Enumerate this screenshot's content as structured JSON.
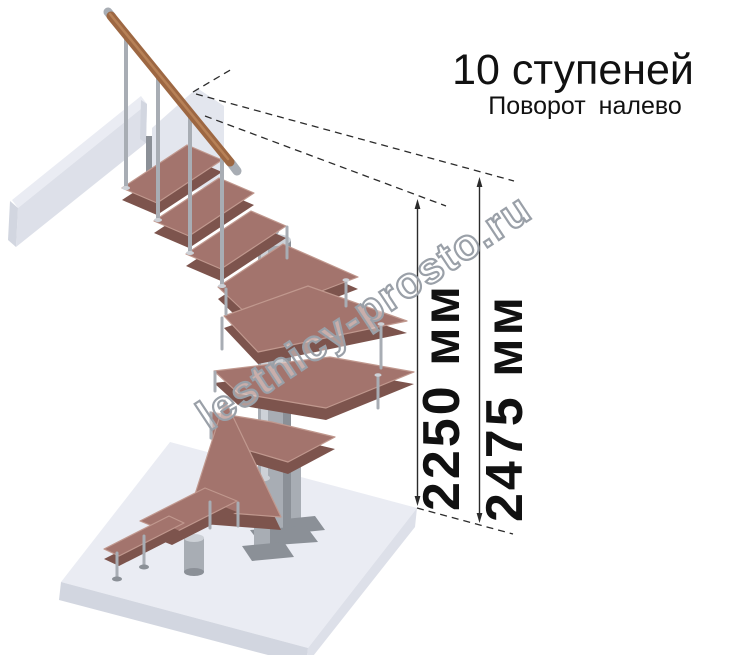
{
  "title": "10 ступеней",
  "subtitle": "Поворот налево",
  "dimensions": [
    {
      "label": "2250 мм"
    },
    {
      "label": "2475 мм"
    }
  ],
  "watermark": "lestnicy-prosto.ru",
  "colors": {
    "wood_top": "#a3746d",
    "wood_side": "#7d544d",
    "wood_nose": "#c0988e",
    "rail": "#9d6742",
    "rail_light": "#c08a5e",
    "metal": "#a8adb4",
    "metal_light": "#cdd1d7",
    "metal_dark": "#8b9097",
    "panel": "#e3e6ee",
    "floor_top": "#eaecf3",
    "floor_side": "#dde0e9",
    "floor_dark": "#d2d6e0",
    "line": "#2b2b2b",
    "watermark_stroke": "#9aa0a8"
  }
}
